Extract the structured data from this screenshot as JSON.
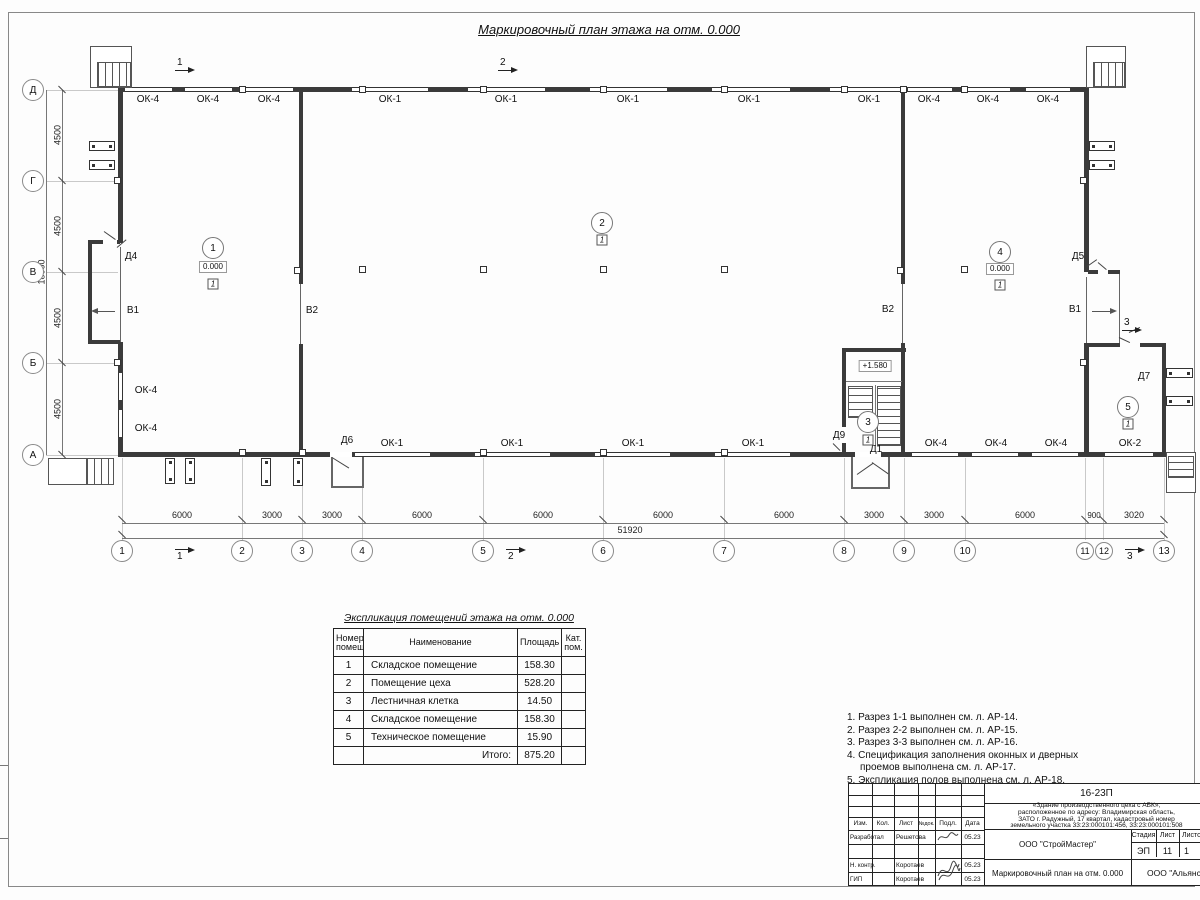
{
  "sheet": {
    "title": "Маркировочный план этажа на отм. 0.000"
  },
  "plan": {
    "axes_left": [
      "Д",
      "Г",
      "В",
      "Б",
      "А"
    ],
    "dims_left": [
      "4500",
      "4500",
      "4500",
      "4500"
    ],
    "dim_left_total": "18000",
    "axes_bottom": [
      "1",
      "2",
      "3",
      "4",
      "5",
      "6",
      "7",
      "8",
      "9",
      "10",
      "11",
      "12",
      "13"
    ],
    "dims_bottom": [
      "6000",
      "3000",
      "3000",
      "6000",
      "6000",
      "6000",
      "6000",
      "3000",
      "3000",
      "6000",
      "900",
      "3020"
    ],
    "dim_bottom_total": "51920",
    "windows_top": [
      "ОК-4",
      "ОК-4",
      "ОК-4",
      "ОК-1",
      "ОК-1",
      "ОК-1",
      "ОК-1",
      "ОК-1",
      "ОК-4",
      "ОК-4",
      "ОК-4"
    ],
    "windows_bottom": [
      "ОК-1",
      "ОК-1",
      "ОК-1",
      "ОК-1",
      "ОК-4",
      "ОК-4",
      "ОК-4",
      "ОК-2"
    ],
    "windows_left": [
      "ОК-4",
      "ОК-4"
    ],
    "doors": {
      "d1": "Д1",
      "d4": "Д4",
      "d5": "Д5",
      "d6": "Д6",
      "d7": "Д7",
      "d9": "Д9"
    },
    "gates": {
      "v1_left": "В1",
      "v2_left": "В2",
      "v2_right": "В2",
      "v1_right": "В1"
    },
    "rooms": [
      {
        "num": "1",
        "elev": "0.000",
        "floor": "1"
      },
      {
        "num": "2",
        "floor": "1"
      },
      {
        "num": "3",
        "floor": "1"
      },
      {
        "num": "4",
        "elev": "0.000",
        "floor": "1"
      },
      {
        "num": "5",
        "floor": "1"
      }
    ],
    "stair_elev": "+1.580",
    "sections": {
      "s1": "1",
      "s2": "2",
      "s3": "3"
    }
  },
  "expl_table": {
    "title": "Экспликация помещений этажа на отм. 0.000",
    "headers": {
      "number": "Номер помещ.",
      "name": "Наименование",
      "area": "Площадь",
      "cat": "Кат. пом."
    },
    "rows": [
      [
        "1",
        "Складское помещение",
        "158.30"
      ],
      [
        "2",
        "Помещение цеха",
        "528.20"
      ],
      [
        "3",
        "Лестничная клетка",
        "14.50"
      ],
      [
        "4",
        "Складское помещение",
        "158.30"
      ],
      [
        "5",
        "Техническое помещение",
        "15.90"
      ]
    ],
    "total_label": "Итого:",
    "total_value": "875.20"
  },
  "notes": [
    "1. Разрез 1-1 выполнен см. л. АР-14.",
    "2. Разрез 2-2 выполнен см. л. АР-15.",
    "3. Разрез 3-3 выполнен см. л. АР-16.",
    "4. Спецификация заполнения оконных и дверных проемов выполнена см. л. АР-17.",
    "5. Экспликация полов выполнена см. л. АР-18."
  ],
  "titleblock": {
    "code": "16-23П",
    "object_lines": [
      "«Здание производственного цеха с АБК»,",
      "расположенное по адресу: Владимирская область,",
      "ЗАТО г. Радужный, 17 квартал, кадастровый номер",
      "земельного участка 33:23:000101:456, 33:23:000101:508"
    ],
    "cols": {
      "izm": "Изм.",
      "kol": "Кол.",
      "list": "Лист",
      "ndok": "№док.",
      "podp": "Подл.",
      "data": "Дата"
    },
    "rows": [
      {
        "role": "Разработал",
        "name": "Решетова",
        "date": "05.23"
      },
      {
        "role": "Н. контр.",
        "name": "Коротаев",
        "date": "05.23"
      },
      {
        "role": "ГИП",
        "name": "Коротаев",
        "date": "05.23"
      }
    ],
    "org": "ООО \"СтройМастер\"",
    "stage_label": "Стадия",
    "sheet_label": "Лист",
    "sheets_label": "Листов",
    "stage": "ЭП",
    "sheet": "11",
    "sheets": "1",
    "doc_title": "Маркировочный план на отм. 0.000",
    "org2": "ООО \"Альянс\""
  }
}
